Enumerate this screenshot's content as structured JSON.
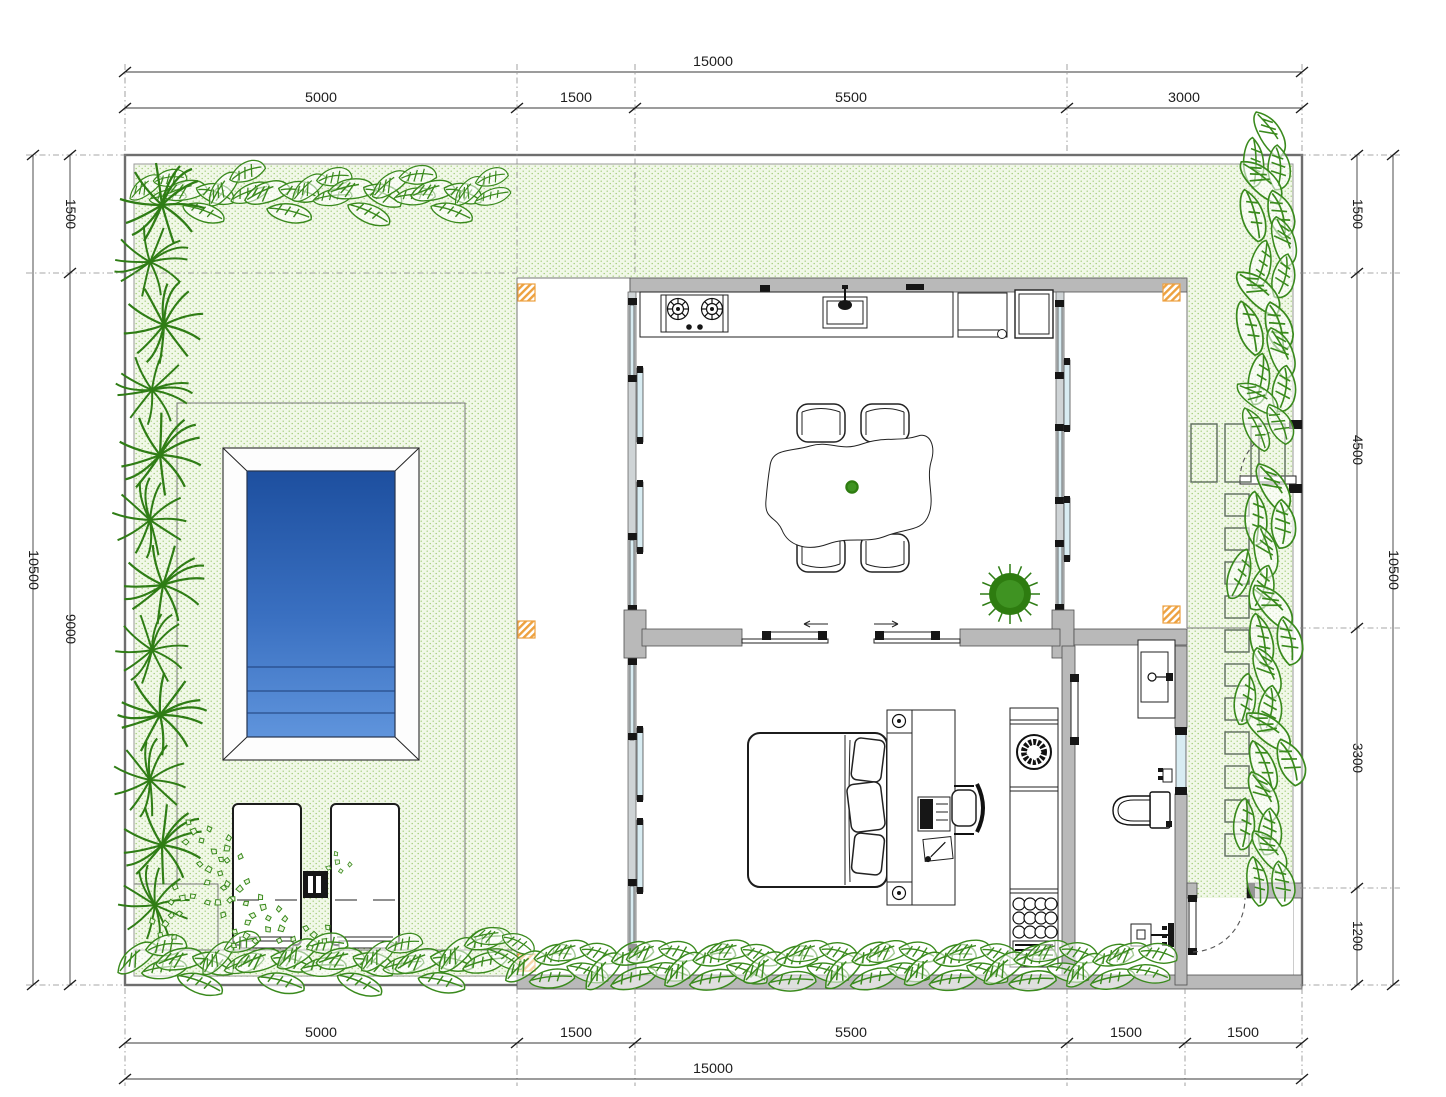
{
  "dims": {
    "top": {
      "total": "15000",
      "chain": [
        "5000",
        "1500",
        "5500",
        "3000"
      ]
    },
    "bottom": {
      "total": "15000",
      "chain": [
        "5000",
        "1500",
        "5500",
        "1500",
        "1500"
      ]
    },
    "left": {
      "total": "10500",
      "chain": [
        "1500",
        "9000"
      ]
    },
    "right": {
      "total": "10500",
      "chain": [
        "1500",
        "4500",
        "3300",
        "1200"
      ]
    }
  },
  "colors": {
    "wallg": "#b9b9b9",
    "wallo": "#4f4f4f",
    "garden-bg": "#f1f8e8",
    "garden-dot": "#a3cc7a",
    "plant": "#3a8a1d",
    "plant-d": "#2f7d15",
    "glass": "#d8ecf2",
    "column": "#eda13f",
    "pool-deep": "#1d4f9f",
    "pool-mid": "#3a70c1",
    "pool-shallow": "#5f94dc",
    "dim": "#1d1d1d"
  }
}
